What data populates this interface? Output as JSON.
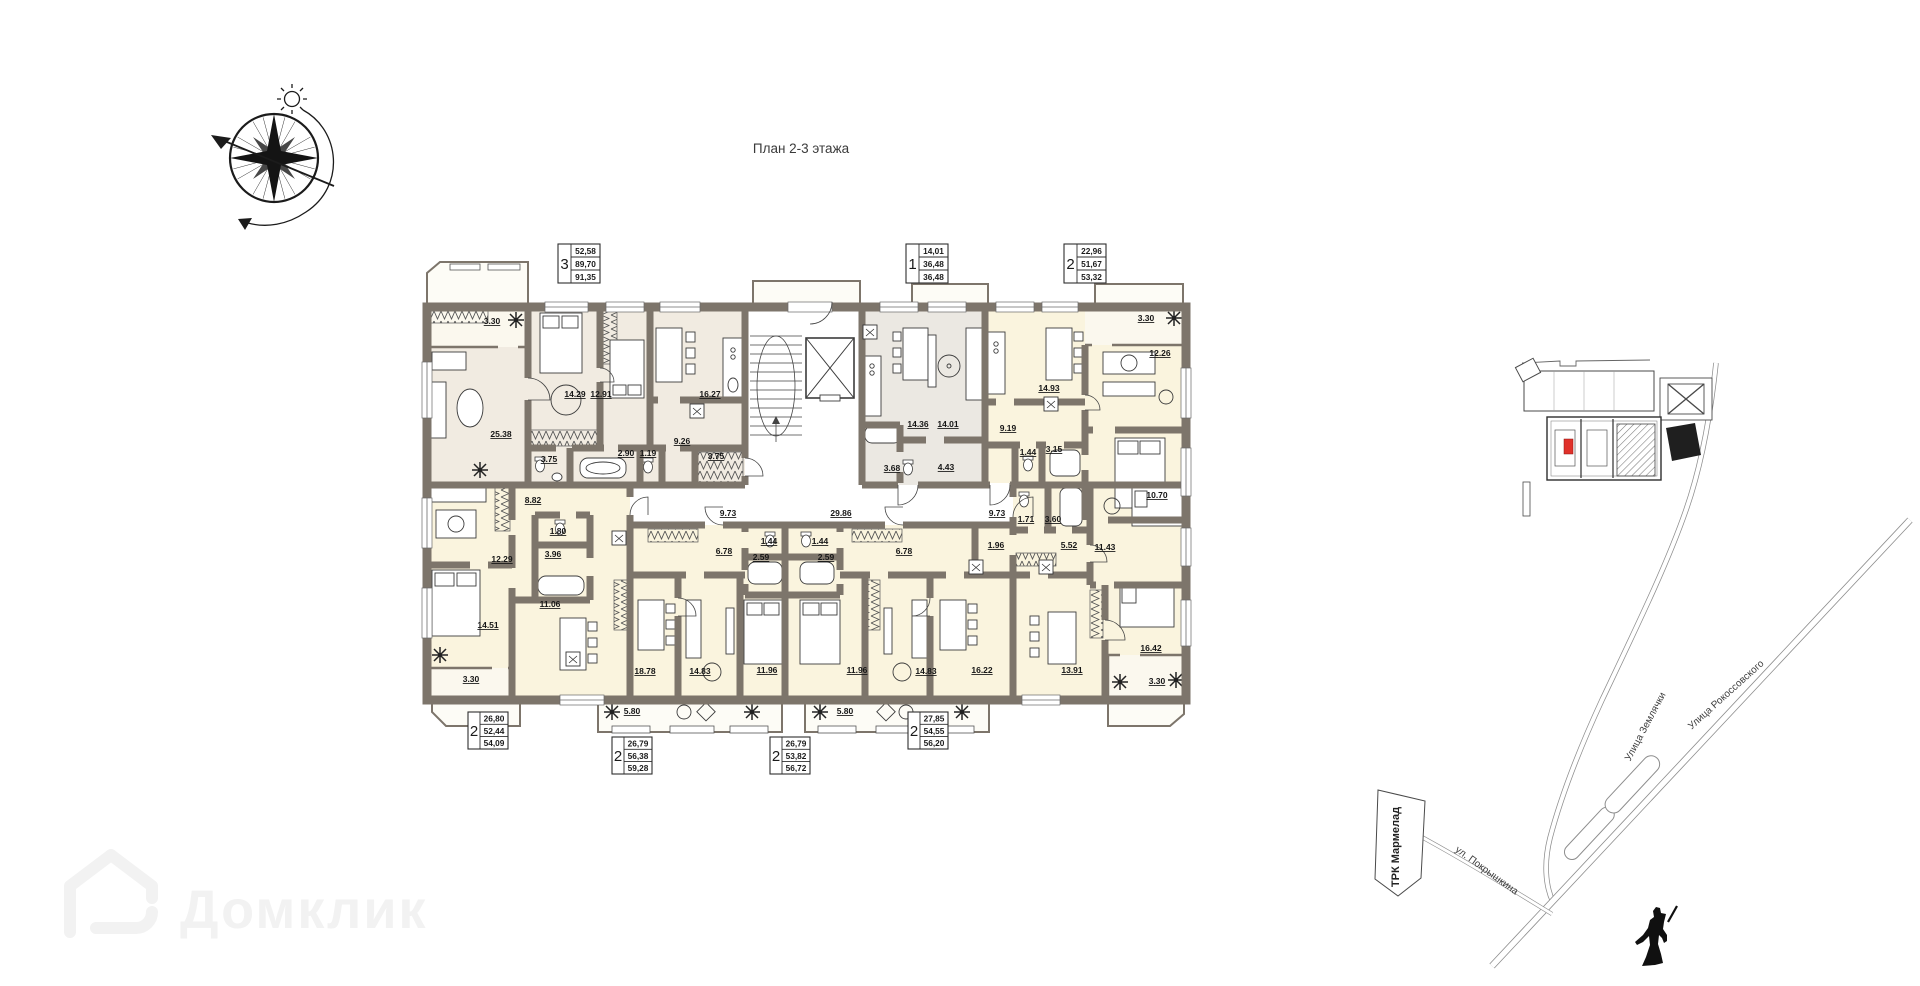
{
  "title": "План 2-3 этажа",
  "watermark": {
    "brand": "Домклик"
  },
  "apartment_tables": [
    {
      "rooms": "3",
      "living_area": "52,58",
      "area": "89,70",
      "total_area": "91,35"
    },
    {
      "rooms": "1",
      "living_area": "14,01",
      "area": "36,48",
      "total_area": "36,48"
    },
    {
      "rooms": "2",
      "living_area": "22,96",
      "area": "51,67",
      "total_area": "53,32"
    },
    {
      "rooms": "2",
      "living_area": "26,80",
      "area": "52,44",
      "total_area": "54,09"
    },
    {
      "rooms": "2",
      "living_area": "26,79",
      "area": "56,38",
      "total_area": "59,28"
    },
    {
      "rooms": "2",
      "living_area": "26,79",
      "area": "53,82",
      "total_area": "56,72"
    },
    {
      "rooms": "2",
      "living_area": "27,85",
      "area": "54,55",
      "total_area": "56,20"
    }
  ],
  "plan": {
    "corridors": {
      "left": "9.73",
      "center": "29.86",
      "right": "9.73"
    },
    "unit_a": {
      "balcony": "3.30",
      "living": "25.38",
      "bedroom1": "14.29",
      "bedroom2": "12.91",
      "kitchen": "16.27",
      "hall": "9.26",
      "bath": "3.75",
      "shower": "2.90",
      "wc": "1.19",
      "wardrobe": "3.75"
    },
    "unit_b": {
      "kitchen": "14.36",
      "living": "14.01",
      "bath": "3.68",
      "hall": "4.43"
    },
    "unit_c": {
      "kitchen": "14.93",
      "hall": "9.19",
      "wc": "1.44",
      "bath": "3.15",
      "balcony": "3.30",
      "living": "12.26",
      "bedroom": "10.70"
    },
    "unit_d": {
      "hall": "8.82",
      "wc": "1.80",
      "bath": "3.96",
      "bedroom1": "12.29",
      "kitchen": "11.06",
      "bedroom2": "14.51",
      "balcony": "3.30"
    },
    "unit_e": {
      "hall": "6.78",
      "wc": "1.44",
      "bath": "2.59",
      "kitchen": "18.78",
      "living": "14.83",
      "bedroom": "11.96",
      "balcony": "5.80"
    },
    "unit_f": {
      "wc": "1.44",
      "bath": "2.59",
      "hall": "6.78",
      "bedroom": "11.96",
      "living": "14.83",
      "kitchen": "16.22",
      "balcony": "5.80"
    },
    "unit_g": {
      "wc": "1.71",
      "bath": "3.60",
      "hall_small": "1.96",
      "hall": "5.52",
      "bedroom": "11.43",
      "kitchen": "13.91",
      "living": "16.42",
      "balcony": "3.30"
    }
  },
  "site_map": {
    "streets": {
      "zemlyachki": "Улица Землячки",
      "rokossovskogo": "Улица Рокоссовского",
      "pokryshkina": "ул. Покрышкина"
    },
    "landmark": "ТРК Мармелад",
    "highlight_color": "#e0312a"
  }
}
